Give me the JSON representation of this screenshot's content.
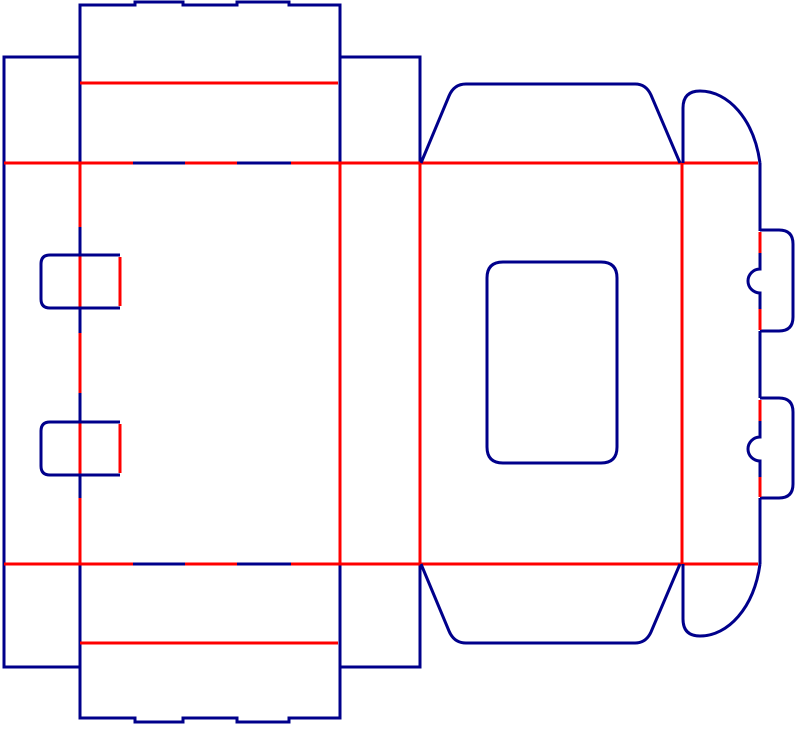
{
  "diagram": {
    "title": "box-dieline-template",
    "type": "packaging-dieline",
    "canvas": {
      "width": 800,
      "height": 729,
      "background": "#ffffff"
    },
    "colors": {
      "cut": "#00008B",
      "crease": "#FF0000"
    },
    "stroke_width": 3,
    "elements": [
      {
        "name": "top-tuck-flap-outline",
        "kind": "cut",
        "d": "M 80 163 L 80 5 L 135 5 L 135 2 L 183 2 L 183 5 L 237 5 L 237 2 L 289 2 L 289 5 L 340 5 L 340 163"
      },
      {
        "name": "top-flap-crease",
        "kind": "crease",
        "d": "M 80 83 L 338 83"
      },
      {
        "name": "bottom-tuck-flap-outline",
        "kind": "cut",
        "d": "M 80 564 L 80 718 L 135 718 L 135 722 L 183 722 L 183 718 L 237 718 L 237 722 L 289 722 L 289 718 L 340 718 L 340 564"
      },
      {
        "name": "bottom-flap-crease",
        "kind": "crease",
        "d": "M 80 643 L 338 643"
      },
      {
        "name": "left-glue-strip-outline",
        "kind": "cut",
        "d": "M 80 57 L 4 57 L 4 667 L 80 667"
      },
      {
        "name": "top-right-side-strip",
        "kind": "cut",
        "d": "M 341 57 L 420 57 L 420 163"
      },
      {
        "name": "bottom-right-side-strip",
        "kind": "cut",
        "d": "M 420 564 L 420 667 L 341 667"
      },
      {
        "name": "top-fold-crease-left",
        "kind": "crease",
        "d": "M 4 163 L 133 163"
      },
      {
        "name": "top-fold-cut-notch-1",
        "kind": "cut",
        "d": "M 133 163 L 185 163"
      },
      {
        "name": "top-fold-crease-mid",
        "kind": "crease",
        "d": "M 185 163 L 237 163"
      },
      {
        "name": "top-fold-cut-notch-2",
        "kind": "cut",
        "d": "M 237 163 L 291 163"
      },
      {
        "name": "top-fold-crease-right",
        "kind": "crease",
        "d": "M 291 163 L 758 163"
      },
      {
        "name": "bottom-fold-crease-left",
        "kind": "crease",
        "d": "M 4 564 L 133 564"
      },
      {
        "name": "bottom-fold-cut-notch-1",
        "kind": "cut",
        "d": "M 133 564 L 185 564"
      },
      {
        "name": "bottom-fold-crease-mid",
        "kind": "crease",
        "d": "M 185 564 L 237 564"
      },
      {
        "name": "bottom-fold-cut-notch-2",
        "kind": "cut",
        "d": "M 237 564 L 291 564"
      },
      {
        "name": "bottom-fold-crease-right",
        "kind": "crease",
        "d": "M 291 564 L 758 564"
      },
      {
        "name": "vertical-crease-front-right",
        "kind": "crease",
        "d": "M 340 163 L 340 564"
      },
      {
        "name": "vertical-crease-side-right",
        "kind": "crease",
        "d": "M 420 163 L 420 564"
      },
      {
        "name": "vertical-crease-back-right",
        "kind": "crease",
        "d": "M 682 163 L 682 564"
      },
      {
        "name": "glue-edge-crease-seg-1",
        "kind": "crease",
        "d": "M 80 163 L 80 227"
      },
      {
        "name": "glue-edge-cut-seg-1",
        "kind": "cut",
        "d": "M 80 227 L 80 256"
      },
      {
        "name": "glue-edge-crease-seg-2",
        "kind": "crease",
        "d": "M 80 256 L 80 307"
      },
      {
        "name": "glue-edge-cut-seg-2",
        "kind": "cut",
        "d": "M 80 307 L 80 333"
      },
      {
        "name": "glue-edge-crease-seg-3",
        "kind": "crease",
        "d": "M 80 333 L 80 393"
      },
      {
        "name": "glue-edge-cut-seg-3",
        "kind": "cut",
        "d": "M 80 393 L 80 422"
      },
      {
        "name": "glue-edge-crease-seg-4",
        "kind": "crease",
        "d": "M 80 422 L 80 475"
      },
      {
        "name": "glue-edge-cut-seg-4",
        "kind": "cut",
        "d": "M 80 475 L 80 498"
      },
      {
        "name": "glue-edge-crease-seg-5",
        "kind": "crease",
        "d": "M 80 498 L 80 564"
      },
      {
        "name": "left-lock-tab-1-outline",
        "kind": "cut",
        "d": "M 120 255 L 50 255 Q 41 255 41 264 L 41 299 Q 41 308 50 308 L 120 308"
      },
      {
        "name": "left-lock-tab-1-fold",
        "kind": "crease",
        "d": "M 120 257 L 120 306"
      },
      {
        "name": "left-lock-tab-2-outline",
        "kind": "cut",
        "d": "M 120 422 L 50 422 Q 41 422 41 431 L 41 466 Q 41 475 50 475 L 120 475"
      },
      {
        "name": "left-lock-tab-2-fold",
        "kind": "crease",
        "d": "M 120 424 L 120 473"
      },
      {
        "name": "display-window-cutout",
        "kind": "cut",
        "d": "M 503 262 L 601 262 Q 617 262 617 278 L 617 447 Q 617 463 601 463 L 503 463 Q 487 463 487 447 L 487 278 Q 487 262 503 262 Z"
      },
      {
        "name": "top-dust-flap",
        "kind": "cut",
        "d": "M 421 163 L 449 96 Q 454 84 466 84 L 635 84 Q 646 84 651 95 L 680 163"
      },
      {
        "name": "bottom-dust-flap",
        "kind": "cut",
        "d": "M 421 564 L 449 631 Q 454 643 466 643 L 635 643 Q 646 643 651 632 L 680 564"
      },
      {
        "name": "top-arc-flap",
        "kind": "cut",
        "d": "M 683 163 L 683 108 Q 683 91 700 91 C 728 91 754 119 760 163"
      },
      {
        "name": "bottom-arc-flap",
        "kind": "cut",
        "d": "M 683 564 L 683 619 Q 683 636 700 636 C 728 636 754 608 760 564"
      },
      {
        "name": "right-edge-cut-upper",
        "kind": "cut",
        "d": "M 760 163 L 760 231"
      },
      {
        "name": "right-lock-tab-1-outline",
        "kind": "cut",
        "d": "M 760 230 L 779 230 Q 793 230 793 244 L 793 317 Q 793 331 779 331 L 760 331"
      },
      {
        "name": "right-lock-tab-1-fold-top",
        "kind": "crease",
        "d": "M 760 232 L 760 253"
      },
      {
        "name": "right-lock-tab-1-bump",
        "kind": "cut",
        "d": "M 760 253 L 760 269 A 12 12 0 0 0 760 293 L 760 309"
      },
      {
        "name": "right-lock-tab-1-fold-bottom",
        "kind": "crease",
        "d": "M 760 309 L 760 330"
      },
      {
        "name": "right-edge-cut-middle",
        "kind": "cut",
        "d": "M 760 331 L 760 398"
      },
      {
        "name": "right-lock-tab-2-outline",
        "kind": "cut",
        "d": "M 760 398 L 779 398 Q 793 398 793 412 L 793 484 Q 793 498 779 498 L 760 498"
      },
      {
        "name": "right-lock-tab-2-fold-top",
        "kind": "crease",
        "d": "M 760 400 L 760 421"
      },
      {
        "name": "right-lock-tab-2-bump",
        "kind": "cut",
        "d": "M 760 421 L 760 437 A 12 12 0 0 0 760 461 L 760 477"
      },
      {
        "name": "right-lock-tab-2-fold-bottom",
        "kind": "crease",
        "d": "M 760 477 L 760 497"
      },
      {
        "name": "right-edge-cut-lower",
        "kind": "cut",
        "d": "M 760 498 L 760 564"
      }
    ]
  }
}
